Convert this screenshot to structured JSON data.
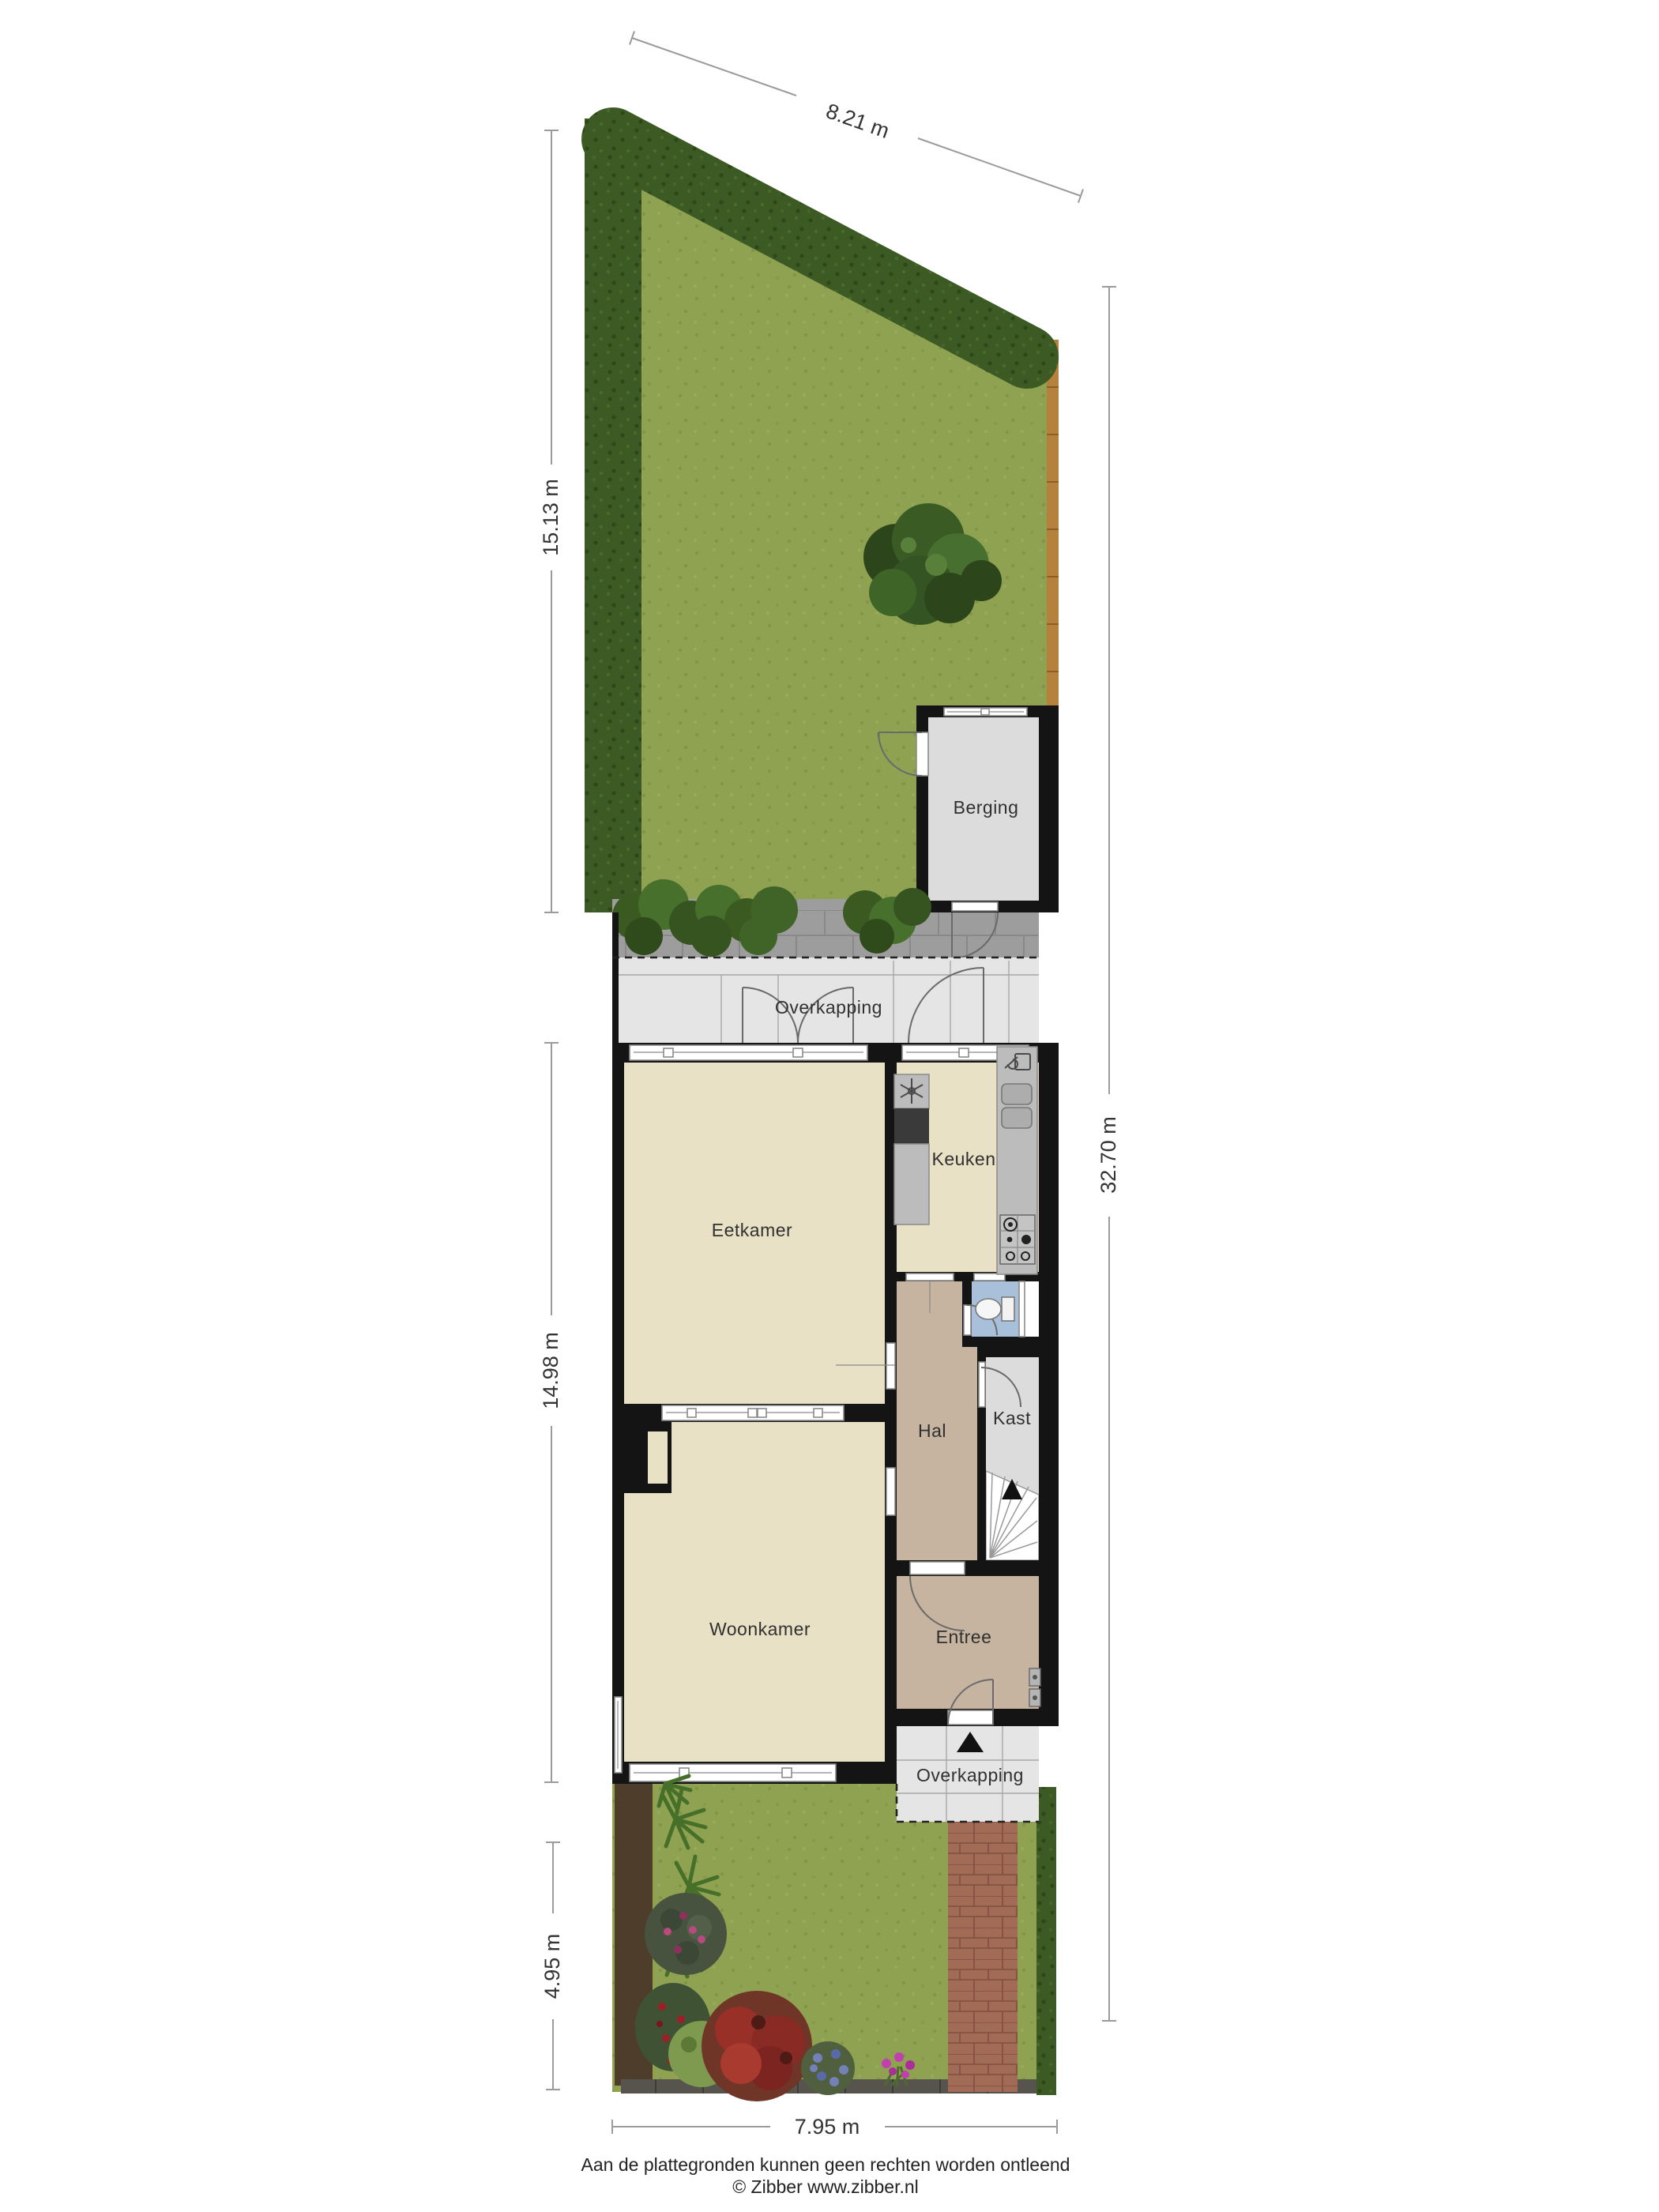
{
  "plan": {
    "rooms": {
      "berging": "Berging",
      "overkapping_back": "Overkapping",
      "keuken": "Keuken",
      "eetkamer": "Eetkamer",
      "hal": "Hal",
      "kast": "Kast",
      "woonkamer": "Woonkamer",
      "entree": "Entree",
      "overkapping_front": "Overkapping"
    },
    "dimensions": {
      "top_width": "8.21 m",
      "back_garden_depth": "15.13 m",
      "house_depth": "14.98 m",
      "front_garden_depth": "4.95 m",
      "total_depth": "32.70 m",
      "front_width": "7.95 m"
    },
    "footer": {
      "disclaimer": "Aan de plattegronden kunnen geen rechten worden ontleend",
      "credit": "© Zibber www.zibber.nl"
    },
    "icons": {
      "hood_fan": "fan-icon",
      "faucet": "faucet-icon",
      "gas_hob": "gas-hob-icon",
      "toilet": "toilet-icon",
      "stairs_arrow": "stairs-up-arrow-icon",
      "entrance_arrow": "entrance-arrow-icon"
    },
    "colors": {
      "grass": "#8fa251",
      "grass_dot": "#81944a",
      "hedge": "#3c5a23",
      "hedge_dot": "#2e4719",
      "fence": "#b5813d",
      "wall": "#141414",
      "floor_beige": "#e9e1c6",
      "floor_taupe": "#c6b4a1",
      "floor_gray": "#dcdcdc",
      "floor_overkapping": "#e5e5e5",
      "floor_toilet": "#a9c0da",
      "paving": "#9d9d9d",
      "brick_path": "#a26b55",
      "counter": "#bcbcbc",
      "dim_line": "#9b9b9b",
      "label_text": "#303030"
    }
  }
}
